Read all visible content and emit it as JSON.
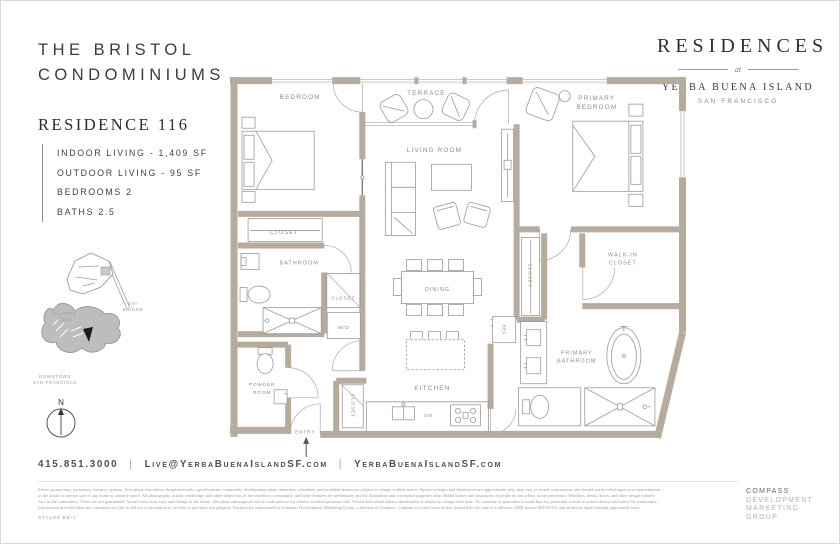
{
  "page": {
    "brand_line1": "THE BRISTOL",
    "brand_line2": "CONDOMINIUMS"
  },
  "badge": {
    "title": "RESIDENCES",
    "at": "at",
    "island": "YERBA BUENA ISLAND",
    "city": "SAN FRANCISCO"
  },
  "residence": {
    "name": "RESIDENCE 116",
    "specs": [
      "INDOOR LIVING - 1,409 SF",
      "OUTDOOR LIVING - 95 SF",
      "BEDROOMS 2",
      "BATHS 2.5"
    ]
  },
  "plan": {
    "bedroom": "BEDROOM",
    "terrace": "TERRACE",
    "living_room": "LIVING ROOM",
    "primary_bedroom_l1": "PRIMARY",
    "primary_bedroom_l2": "BEDROOM",
    "bedroom_closet": "CLOSET",
    "bathroom": "BATHROOM",
    "hall_closet": "CLOSET",
    "washer_dryer": "W/D",
    "powder_l1": "POWDER",
    "powder_l2": "ROOM",
    "entry": "ENTRY",
    "entry_closet": "CLOSET",
    "kitchen": "KITCHEN",
    "dishwasher": "DW",
    "refrigerator": "REF",
    "dining": "DINING",
    "primary_closet": "CLOSET",
    "walk_in_l1": "WALK-IN",
    "walk_in_l2": "CLOSET",
    "primary_bath_l1": "PRIMARY",
    "primary_bath_l2": "BATHROOM"
  },
  "map": {
    "bay_bridge_l1": "BAY",
    "bay_bridge_l2": "BRIDGE",
    "clipper_l1": "CLIPPER",
    "clipper_l2": "COVE",
    "downtown_l1": "DOWNTOWN",
    "downtown_l2": "SAN FRANCISCO",
    "north": "N"
  },
  "contact": {
    "phone": "415.851.3000",
    "sep1": "|",
    "email": "Live@YerbaBuenaIslandSF.com",
    "sep2": "|",
    "website": "YerbaBuenaIslandSF.com"
  },
  "legal": {
    "lines": [
      "Prices, promotions, incentives, features, options, floor plans, elevations, design materials, specifications, community development plans, amenities, schedules, and available homes are subject to change without notice. Square footages and dimensions are approximate only, may vary in actual construction, and should not be relied upon as a representation",
      "of the actual or precise size of any home or amenity space. All photographs, artistic renderings, and other depictions of the residence, community, and other features are preliminary and for illustrative and conceptual purposes only. Model homes and depictions of people do not reflect racial preference. Windows, decks, doors, and other design features",
      "vary in the community. Views are not guaranteed. Actual views may vary and change in the future. Site plans and maps are not to scale and are for relative location purposes only. School and school district information is subject to change over time. No warranty or guarantee is made that any particular school or school district will serve the community.",
      "Information provided does not constitute an offer to sell nor a solicitation of an offer to purchase real property. Exclusively represented by Compass Development Marketing Group, a division of Compass. Compass is a real estate broker licensed by the state of California, DRE license #01527235 and abides by equal housing opportunity laws."
    ],
    "style_no": "STYLE# BB-1"
  },
  "footer_brand": {
    "lines": [
      "COMPASS",
      "DEVELOPMENT",
      "MARKETING",
      "GROUP"
    ]
  },
  "colors": {
    "wall": "#b6ab9d",
    "plan_line": "#9b9b99",
    "plan_label": "#8f8d8a",
    "ink": "#3c3c3c",
    "map_island": "#bdbdbd"
  }
}
